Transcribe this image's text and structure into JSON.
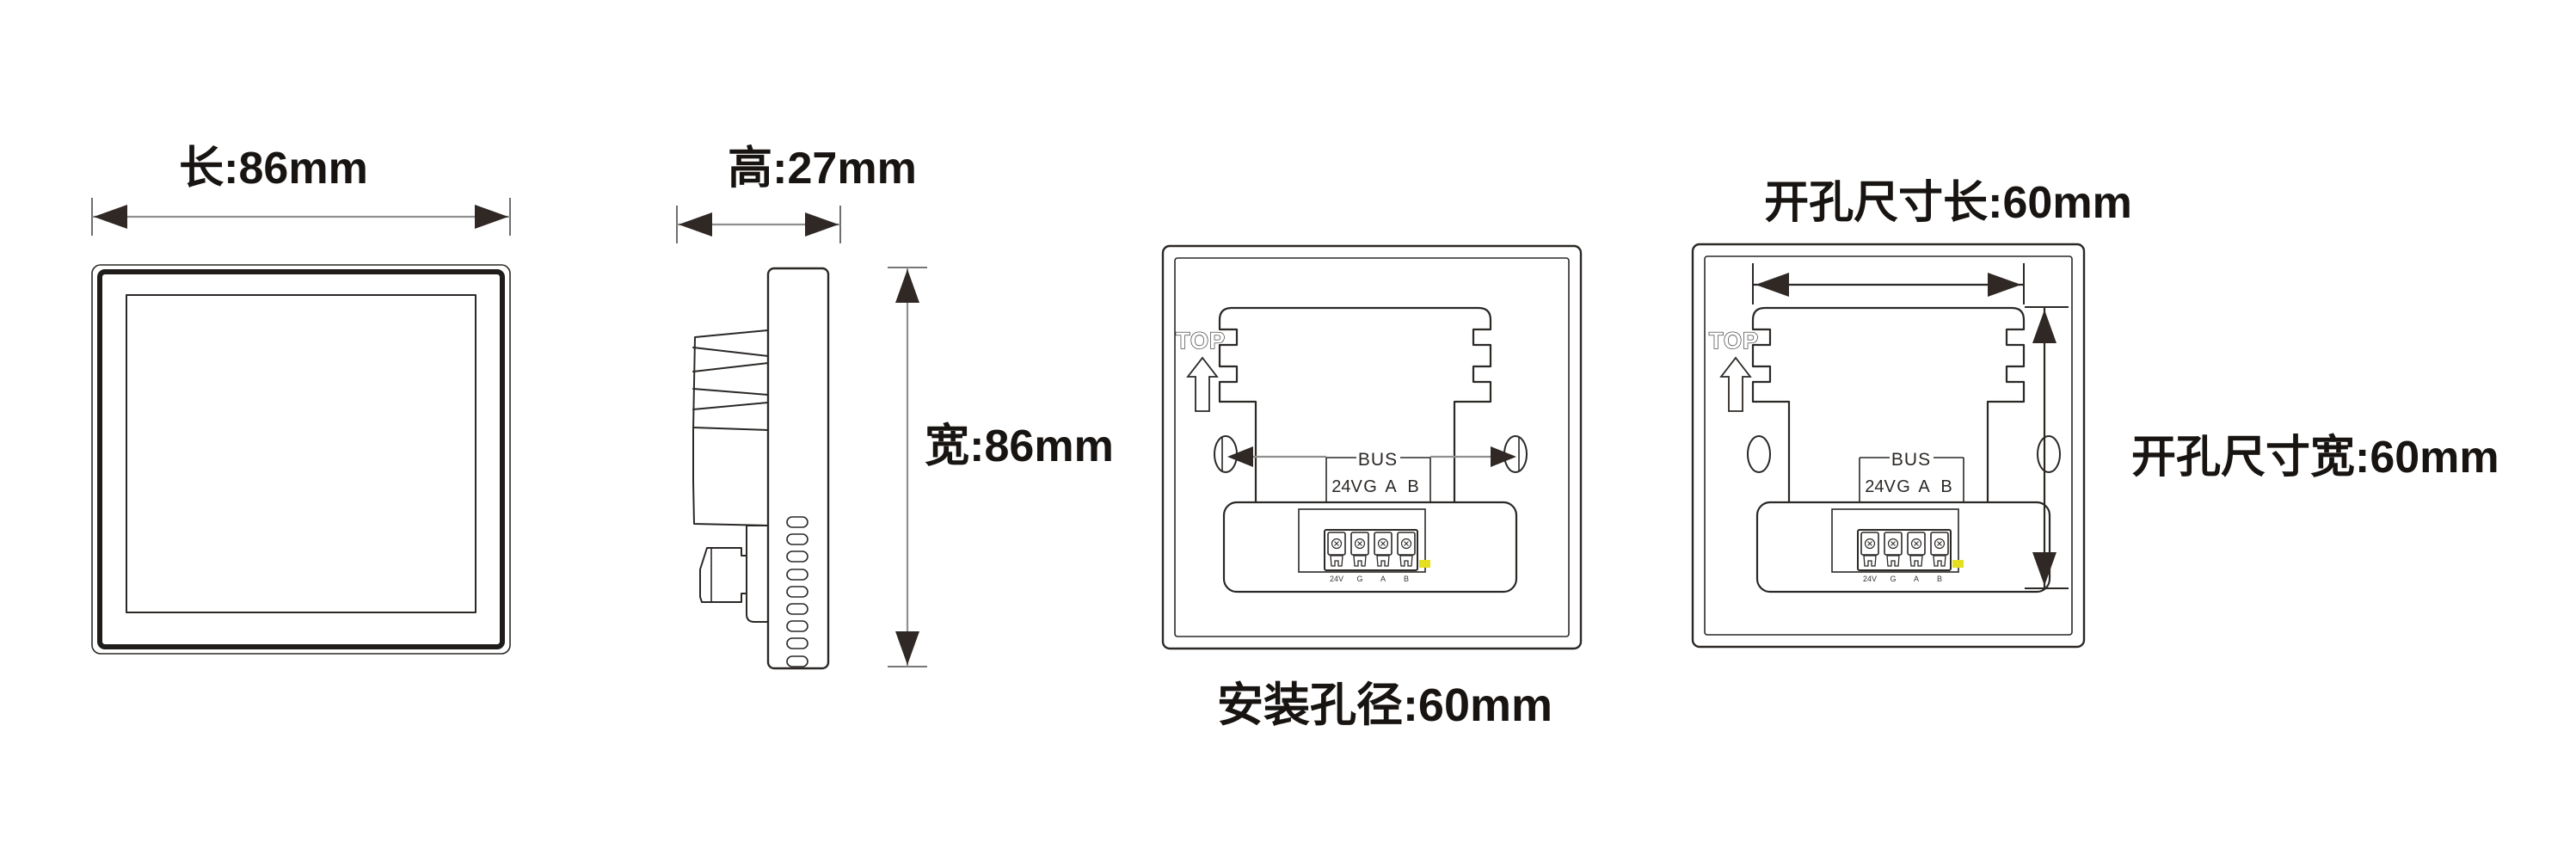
{
  "palette": {
    "background": "#ffffff",
    "line": "#2b2826",
    "dim_line": "#8f8f8f",
    "arrow": "#2f2825",
    "led": "#e6df1f"
  },
  "views": {
    "front": {
      "dim_length": "长:86mm"
    },
    "side": {
      "dim_height": "高:27mm",
      "dim_width": "宽:86mm"
    },
    "back_mount": {
      "top_marker": "TOP",
      "bus_label": "BUS",
      "pins": [
        "24V",
        "G",
        "A",
        "B"
      ],
      "dim_hole": "安装孔径:60mm"
    },
    "back_cutout": {
      "top_marker": "TOP",
      "bus_label": "BUS",
      "pins": [
        "24V",
        "G",
        "A",
        "B"
      ],
      "dim_length": "开孔尺寸长:60mm",
      "dim_width": "开孔尺寸宽:60mm"
    }
  }
}
